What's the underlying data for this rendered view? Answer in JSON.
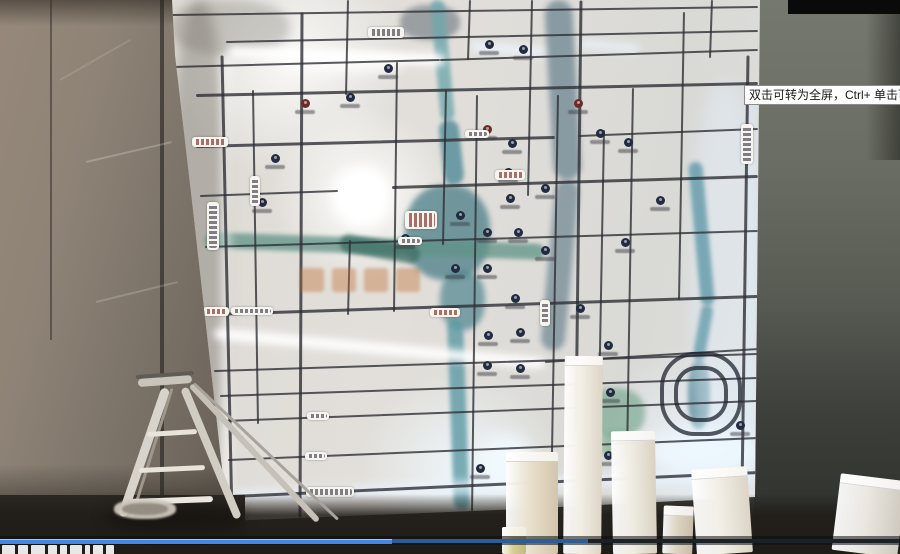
{
  "tooltip": {
    "text": "双击可转为全屏，Ctrl+ 单击可转为"
  },
  "player": {
    "played_color": "#4487e6",
    "buffered_color": "#2c5d97",
    "track_color": "#1c2126",
    "played_px": 392,
    "buffered_px": 588,
    "total_px": 900,
    "caption_block_widths": [
      13,
      10,
      14,
      9,
      7,
      12,
      5,
      10,
      8
    ]
  },
  "scene": {
    "map": {
      "roads": [
        [
          172,
          15,
          758,
          7,
          2
        ],
        [
          226,
          42,
          758,
          31,
          2
        ],
        [
          172,
          67,
          440,
          60,
          2
        ],
        [
          440,
          60,
          758,
          50,
          2
        ],
        [
          196,
          95,
          758,
          83,
          3
        ],
        [
          196,
          146,
          555,
          137,
          3
        ],
        [
          578,
          136,
          758,
          129,
          2
        ],
        [
          200,
          196,
          338,
          191,
          2
        ],
        [
          392,
          187,
          758,
          176,
          3
        ],
        [
          205,
          247,
          758,
          231,
          2
        ],
        [
          212,
          314,
          758,
          296,
          3
        ],
        [
          545,
          362,
          758,
          349,
          2
        ],
        [
          214,
          371,
          758,
          354,
          2
        ],
        [
          220,
          396,
          758,
          378,
          2
        ],
        [
          224,
          421,
          758,
          401,
          2
        ],
        [
          228,
          460,
          758,
          438,
          2
        ],
        [
          232,
          496,
          758,
          472,
          3
        ],
        [
          222,
          55,
          232,
          518,
          3
        ],
        [
          253,
          90,
          258,
          424,
          2
        ],
        [
          302,
          12,
          300,
          517,
          3
        ],
        [
          348,
          0,
          346,
          95,
          2
        ],
        [
          350,
          240,
          348,
          315,
          2
        ],
        [
          397,
          62,
          394,
          312,
          2
        ],
        [
          446,
          90,
          443,
          245,
          2
        ],
        [
          470,
          0,
          468,
          60,
          2
        ],
        [
          477,
          95,
          472,
          515,
          2
        ],
        [
          532,
          0,
          528,
          196,
          2
        ],
        [
          558,
          95,
          551,
          512,
          2
        ],
        [
          581,
          0,
          576,
          430,
          3
        ],
        [
          604,
          130,
          598,
          460,
          2
        ],
        [
          633,
          88,
          627,
          458,
          2
        ],
        [
          684,
          12,
          679,
          300,
          2
        ],
        [
          712,
          0,
          710,
          58,
          2
        ],
        [
          748,
          55,
          742,
          492,
          3
        ]
      ],
      "rivers": [
        [
          437,
          0,
          448,
          120,
          14,
          "#6fa7ad",
          2,
          0.8
        ],
        [
          448,
          120,
          455,
          185,
          20,
          "#58909c",
          2,
          0.85
        ],
        [
          455,
          320,
          462,
          510,
          16,
          "#5d99a4",
          2,
          0.8
        ],
        [
          558,
          0,
          568,
          180,
          28,
          "#51707f",
          3,
          0.6
        ],
        [
          568,
          180,
          552,
          350,
          24,
          "#4e6d7c",
          3,
          0.55
        ],
        [
          205,
          240,
          545,
          252,
          16,
          "#5f9386",
          2,
          0.75
        ],
        [
          340,
          242,
          420,
          256,
          18,
          "#3f7066",
          2,
          0.8
        ],
        [
          695,
          162,
          708,
          305,
          14,
          "#5f98a8",
          2,
          0.8
        ],
        [
          708,
          305,
          698,
          360,
          12,
          "#5f98a8",
          2,
          0.75
        ]
      ],
      "blobs": [
        [
          405,
          185,
          85,
          95,
          "#4b7f88",
          3,
          0.75
        ],
        [
          440,
          270,
          45,
          60,
          "#4f858e",
          3,
          0.7
        ],
        [
          585,
          388,
          60,
          50,
          "#6da186",
          3,
          0.6
        ],
        [
          600,
          430,
          36,
          30,
          "#7aa98c",
          3,
          0.6
        ],
        [
          688,
          360,
          22,
          70,
          "#4f8494",
          2,
          0.8
        ],
        [
          400,
          5,
          60,
          35,
          "#55616b",
          3,
          0.5
        ],
        [
          690,
          80,
          70,
          400,
          "rgba(225,238,248,.5)",
          8,
          1
        ],
        [
          170,
          0,
          58,
          520,
          "rgba(105,100,92,.38)",
          6,
          1
        ],
        [
          170,
          0,
          120,
          55,
          "rgba(110,105,95,.3)",
          5,
          1
        ]
      ],
      "glows": [
        [
          226,
          55,
          226,
          505,
          6,
          "#ffffff",
          5,
          0.9
        ],
        [
          228,
          52,
          445,
          60,
          12,
          "#ffffff",
          4,
          0.95
        ],
        [
          470,
          46,
          545,
          52,
          10,
          "#eef6ff",
          4,
          0.8
        ],
        [
          580,
          43,
          640,
          49,
          9,
          "#eef6ff",
          4,
          0.7
        ],
        [
          214,
          333,
          545,
          363,
          11,
          "#ffffff",
          4,
          0.95
        ],
        [
          232,
          497,
          755,
          474,
          10,
          "#eaf4ff",
          5,
          0.9
        ],
        [
          753,
          96,
          749,
          480,
          5,
          "#dceeff",
          4,
          0.8
        ]
      ],
      "glow_blobs": [
        [
          333,
          167,
          58,
          60,
          "#ffffff",
          6,
          1
        ],
        [
          340,
          174,
          42,
          44,
          "#ffffff",
          2,
          1
        ],
        [
          478,
          435,
          55,
          55,
          "#f2fbff",
          8,
          0.9
        ],
        [
          645,
          428,
          115,
          45,
          "#eef8ff",
          8,
          0.85
        ],
        [
          282,
          55,
          120,
          18,
          "#ffffff",
          6,
          0.8
        ]
      ],
      "markers": [
        [
          305,
          103,
          "r"
        ],
        [
          350,
          97,
          "n"
        ],
        [
          388,
          68,
          "n"
        ],
        [
          489,
          44,
          "n"
        ],
        [
          523,
          49,
          "n"
        ],
        [
          578,
          103,
          "r"
        ],
        [
          600,
          133,
          "n"
        ],
        [
          628,
          142,
          "n"
        ],
        [
          487,
          129,
          "r"
        ],
        [
          512,
          143,
          "n"
        ],
        [
          508,
          172,
          "n"
        ],
        [
          510,
          198,
          "n"
        ],
        [
          460,
          215,
          "n"
        ],
        [
          487,
          232,
          "n"
        ],
        [
          518,
          232,
          "n"
        ],
        [
          545,
          188,
          "n"
        ],
        [
          275,
          158,
          "n"
        ],
        [
          262,
          202,
          "n"
        ],
        [
          405,
          238,
          "n"
        ],
        [
          455,
          268,
          "n"
        ],
        [
          487,
          268,
          "n"
        ],
        [
          515,
          298,
          "n"
        ],
        [
          545,
          250,
          "n"
        ],
        [
          580,
          308,
          "n"
        ],
        [
          488,
          335,
          "n"
        ],
        [
          520,
          332,
          "n"
        ],
        [
          608,
          345,
          "n"
        ],
        [
          487,
          365,
          "n"
        ],
        [
          520,
          368,
          "n"
        ],
        [
          610,
          392,
          "n"
        ],
        [
          608,
          455,
          "n"
        ],
        [
          740,
          425,
          "n"
        ],
        [
          480,
          468,
          "n"
        ],
        [
          625,
          242,
          "n"
        ],
        [
          660,
          200,
          "n"
        ]
      ],
      "pills": [
        [
          368,
          27,
          36,
          11,
          "h",
          "w"
        ],
        [
          192,
          137,
          36,
          10,
          "h",
          "r"
        ],
        [
          203,
          307,
          26,
          9,
          "h",
          "r"
        ],
        [
          231,
          307,
          42,
          8,
          "h",
          "w"
        ],
        [
          430,
          308,
          30,
          9,
          "h",
          "r"
        ],
        [
          307,
          412,
          22,
          8,
          "h",
          "w"
        ],
        [
          305,
          452,
          22,
          8,
          "h",
          "w"
        ],
        [
          306,
          487,
          48,
          10,
          "h",
          "w"
        ],
        [
          741,
          124,
          12,
          40,
          "v",
          "w"
        ],
        [
          207,
          202,
          12,
          48,
          "v",
          "w"
        ],
        [
          250,
          176,
          10,
          30,
          "v",
          "w"
        ],
        [
          495,
          170,
          30,
          10,
          "h",
          "r"
        ],
        [
          405,
          211,
          32,
          18,
          "h",
          "r"
        ],
        [
          398,
          237,
          24,
          8,
          "h",
          "w"
        ],
        [
          540,
          300,
          10,
          26,
          "v",
          "w"
        ],
        [
          465,
          130,
          24,
          8,
          "h",
          "w"
        ]
      ],
      "rings": [
        [
          660,
          352,
          74,
          76
        ],
        [
          674,
          366,
          46,
          48
        ]
      ],
      "watermark": {
        "x": 300,
        "y": 268,
        "count": 4,
        "step": 32
      }
    },
    "ladder": {
      "segments": [
        [
          136,
          377,
          194,
          373,
          4,
          "#5f5c55"
        ],
        [
          138,
          383,
          192,
          379,
          8,
          "#c9c4bb"
        ],
        [
          166,
          388,
          122,
          516,
          9,
          "#d8d4cb"
        ],
        [
          172,
          388,
          132,
          516,
          3,
          "#9e978c"
        ],
        [
          184,
          388,
          238,
          518,
          8,
          "#d2cdc4"
        ],
        [
          191,
          385,
          318,
          521,
          6,
          "#c6c1b8"
        ],
        [
          194,
          383,
          338,
          519,
          3,
          "#a9a49b"
        ],
        [
          147,
          434,
          197,
          431,
          5,
          "#e8e4db"
        ],
        [
          139,
          470,
          205,
          467,
          5,
          "#e8e4db"
        ],
        [
          131,
          502,
          213,
          499,
          6,
          "#ebe7de"
        ]
      ],
      "shadow": [
        105,
        505,
        140,
        26,
        "#161410",
        7,
        0.75
      ],
      "bucket_outer": [
        114,
        499,
        62,
        20,
        "#cdc7bc",
        1,
        0.95
      ],
      "bucket_inner": [
        122,
        503,
        46,
        12,
        "#8e887d",
        1,
        0.9
      ]
    },
    "pillars": [
      [
        506,
        452,
        52,
        102,
        0,
        "#e9e0ce",
        "#d3c5ab"
      ],
      [
        564,
        356,
        38,
        198,
        0.5,
        "#f2eee5",
        "#ddd5c6"
      ],
      [
        612,
        431,
        44,
        123,
        -1,
        "#efece3",
        "#d9d2c2"
      ],
      [
        663,
        506,
        30,
        48,
        2,
        "#ddd4c3",
        "#c8bda9"
      ],
      [
        694,
        468,
        56,
        86,
        -4,
        "#f2efe7",
        "#dcd5c6"
      ],
      [
        836,
        477,
        66,
        77,
        7,
        "#eae7e0",
        "#cfc9bf"
      ],
      [
        502,
        527,
        24,
        27,
        0,
        "#d8cf92",
        "#c4b97e"
      ]
    ],
    "wall_marks": [
      [
        86,
        162,
        172,
        142,
        2,
        "rgba(255,255,255,.22)"
      ],
      [
        96,
        302,
        178,
        282,
        2,
        "rgba(255,255,255,.18)"
      ],
      [
        60,
        80,
        130,
        40,
        2,
        "rgba(255,255,255,.12)"
      ]
    ]
  }
}
